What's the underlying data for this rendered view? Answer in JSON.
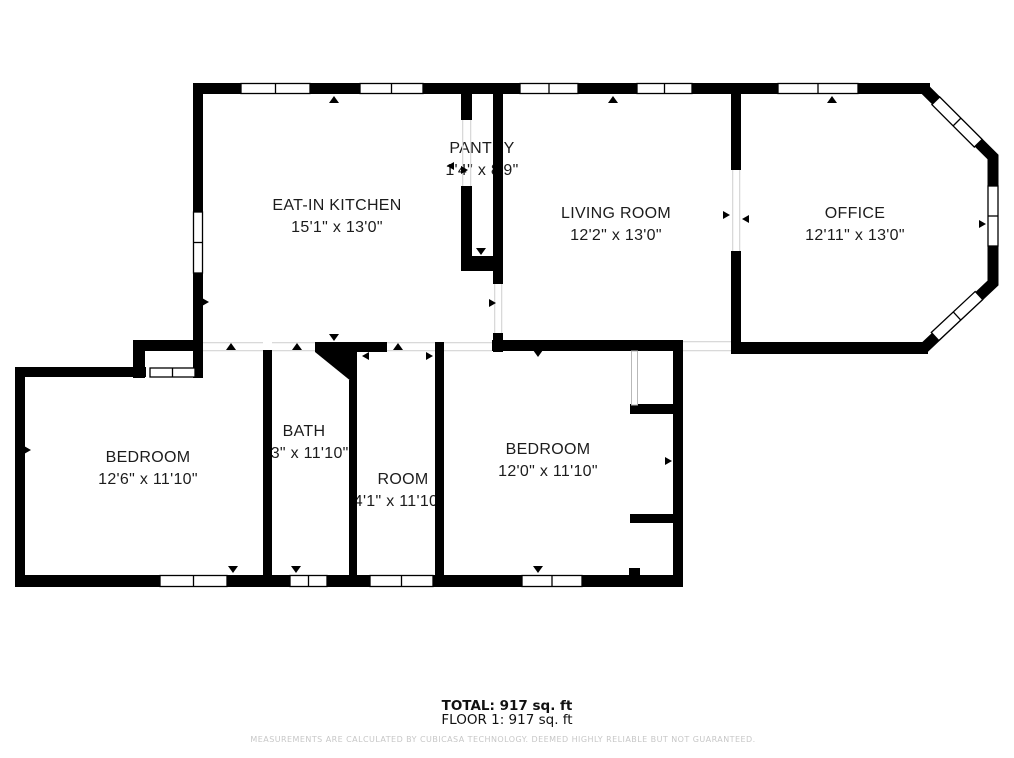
{
  "floorplan": {
    "rooms": [
      {
        "name": "EAT-IN KITCHEN",
        "dims": "15'1\" x 13'0\""
      },
      {
        "name": "PANTRY",
        "dims": "1'4\" x 8'9\""
      },
      {
        "name": "LIVING ROOM",
        "dims": "12'2\" x 13'0\""
      },
      {
        "name": "OFFICE",
        "dims": "12'11\" x 13'0\""
      },
      {
        "name": "BEDROOM",
        "dims": "12'6\" x 11'10\""
      },
      {
        "name": "BATH",
        "dims": "'3\" x 11'10\""
      },
      {
        "name": "ROOM",
        "dims": "4'1\" x 11'10"
      },
      {
        "name": "BEDROOM",
        "dims": "12'0\" x 11'10\""
      }
    ],
    "summary": {
      "total": "TOTAL: 917 sq. ft",
      "floor": "FLOOR 1: 917 sq. ft"
    },
    "disclaimer": "MEASUREMENTS ARE CALCULATED BY CUBICASA TECHNOLOGY. DEEMED HIGHLY RELIABLE BUT NOT GUARANTEED.",
    "colors": {
      "wall": "#000000",
      "background": "#ffffff",
      "disclaimer_text": "#c7c7c7"
    }
  }
}
